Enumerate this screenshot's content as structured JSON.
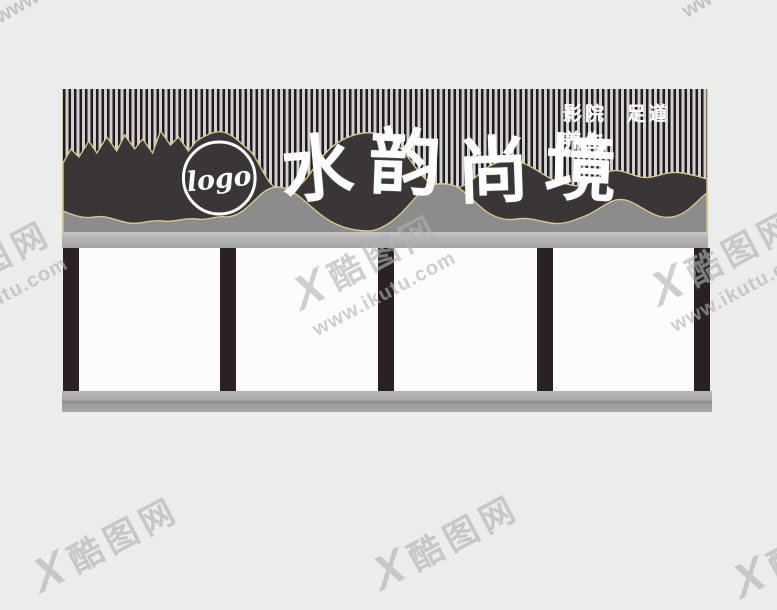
{
  "canvas": {
    "background": "#ececec"
  },
  "sign": {
    "logo": {
      "text": "logo"
    },
    "title": {
      "text": "水韵尚境",
      "chars": [
        "水",
        "韵",
        "尚",
        "境"
      ]
    },
    "subtitle": {
      "text": "影院 足道 养生"
    },
    "colors": {
      "stripe_dark": "#211b1d",
      "stripe_light": "#d2cfd0",
      "wave_dark": "#3a3537",
      "wave_gray": "#8c8c8c",
      "gold_outline": "#d6c887",
      "lettering": "#ffffff",
      "fascia": "#b4b4b4"
    }
  },
  "structure": {
    "pillar_count": 5,
    "pillar_color": "#2a2123",
    "panel_color": "#fcfcfc",
    "base_color": "#a9a9a9"
  },
  "watermark": {
    "mark": "X",
    "site": "酷图网",
    "url": "www.ikutu.com",
    "color": "#b2b2b2",
    "fragments": {
      "top_left": "www",
      "top_right": "ww"
    }
  }
}
